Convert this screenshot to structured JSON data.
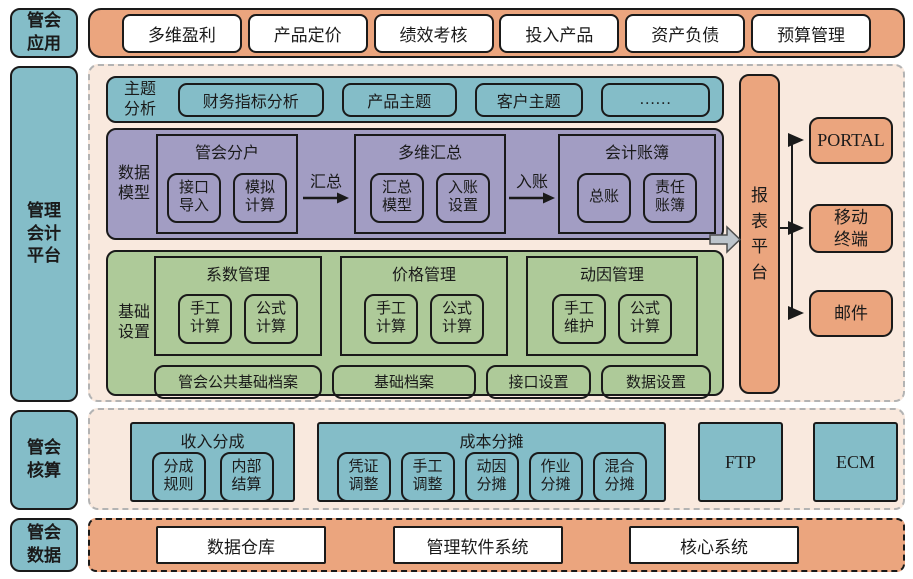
{
  "colors": {
    "teal": "#84bdc8",
    "orange": "#eba57e",
    "peach": "#f9e9de",
    "purple": "#a29dc3",
    "green": "#aeca99",
    "arrow_gray": "#bdc4cb"
  },
  "left_labels": {
    "app": "管会\n应用",
    "platform": "管理\n会计\n平台",
    "accounting": "管会\n核算",
    "data": "管会\n数据"
  },
  "top_apps": [
    "多维盈利",
    "产品定价",
    "绩效考核",
    "投入产品",
    "资产负债",
    "预算管理"
  ],
  "theme": {
    "label": "主题\n分析",
    "items": [
      "财务指标分析",
      "产品主题",
      "客户主题",
      "……"
    ]
  },
  "data_model": {
    "label": "数据\n模型",
    "groups": [
      {
        "title": "管会分户",
        "items": [
          "接口\n导入",
          "模拟\n计算"
        ]
      },
      {
        "title": "多维汇总",
        "items": [
          "汇总\n模型",
          "入账\n设置"
        ]
      },
      {
        "title": "会计账簿",
        "items": [
          "总账",
          "责任\n账簿"
        ]
      }
    ],
    "arrow1": "汇总",
    "arrow2": "入账"
  },
  "base_settings": {
    "label": "基础\n设置",
    "groups": [
      {
        "title": "系数管理",
        "items": [
          "手工\n计算",
          "公式\n计算"
        ]
      },
      {
        "title": "价格管理",
        "items": [
          "手工\n计算",
          "公式\n计算"
        ]
      },
      {
        "title": "动因管理",
        "items": [
          "手工\n维护",
          "公式\n计算"
        ]
      }
    ],
    "footer": [
      "管会公共基础档案",
      "基础档案",
      "接口设置",
      "数据设置"
    ]
  },
  "report_platform": "报\n表\n平\n台",
  "outputs": [
    "PORTAL",
    "移动\n终端",
    "邮件"
  ],
  "accounting": {
    "revenue": {
      "title": "收入分成",
      "items": [
        "分成\n规则",
        "内部\n结算"
      ]
    },
    "cost": {
      "title": "成本分摊",
      "items": [
        "凭证\n调整",
        "手工\n调整",
        "动因\n分摊",
        "作业\n分摊",
        "混合\n分摊"
      ]
    },
    "ftp": "FTP",
    "ecm": "ECM"
  },
  "data_sources": [
    "数据仓库",
    "管理软件系统",
    "核心系统"
  ]
}
